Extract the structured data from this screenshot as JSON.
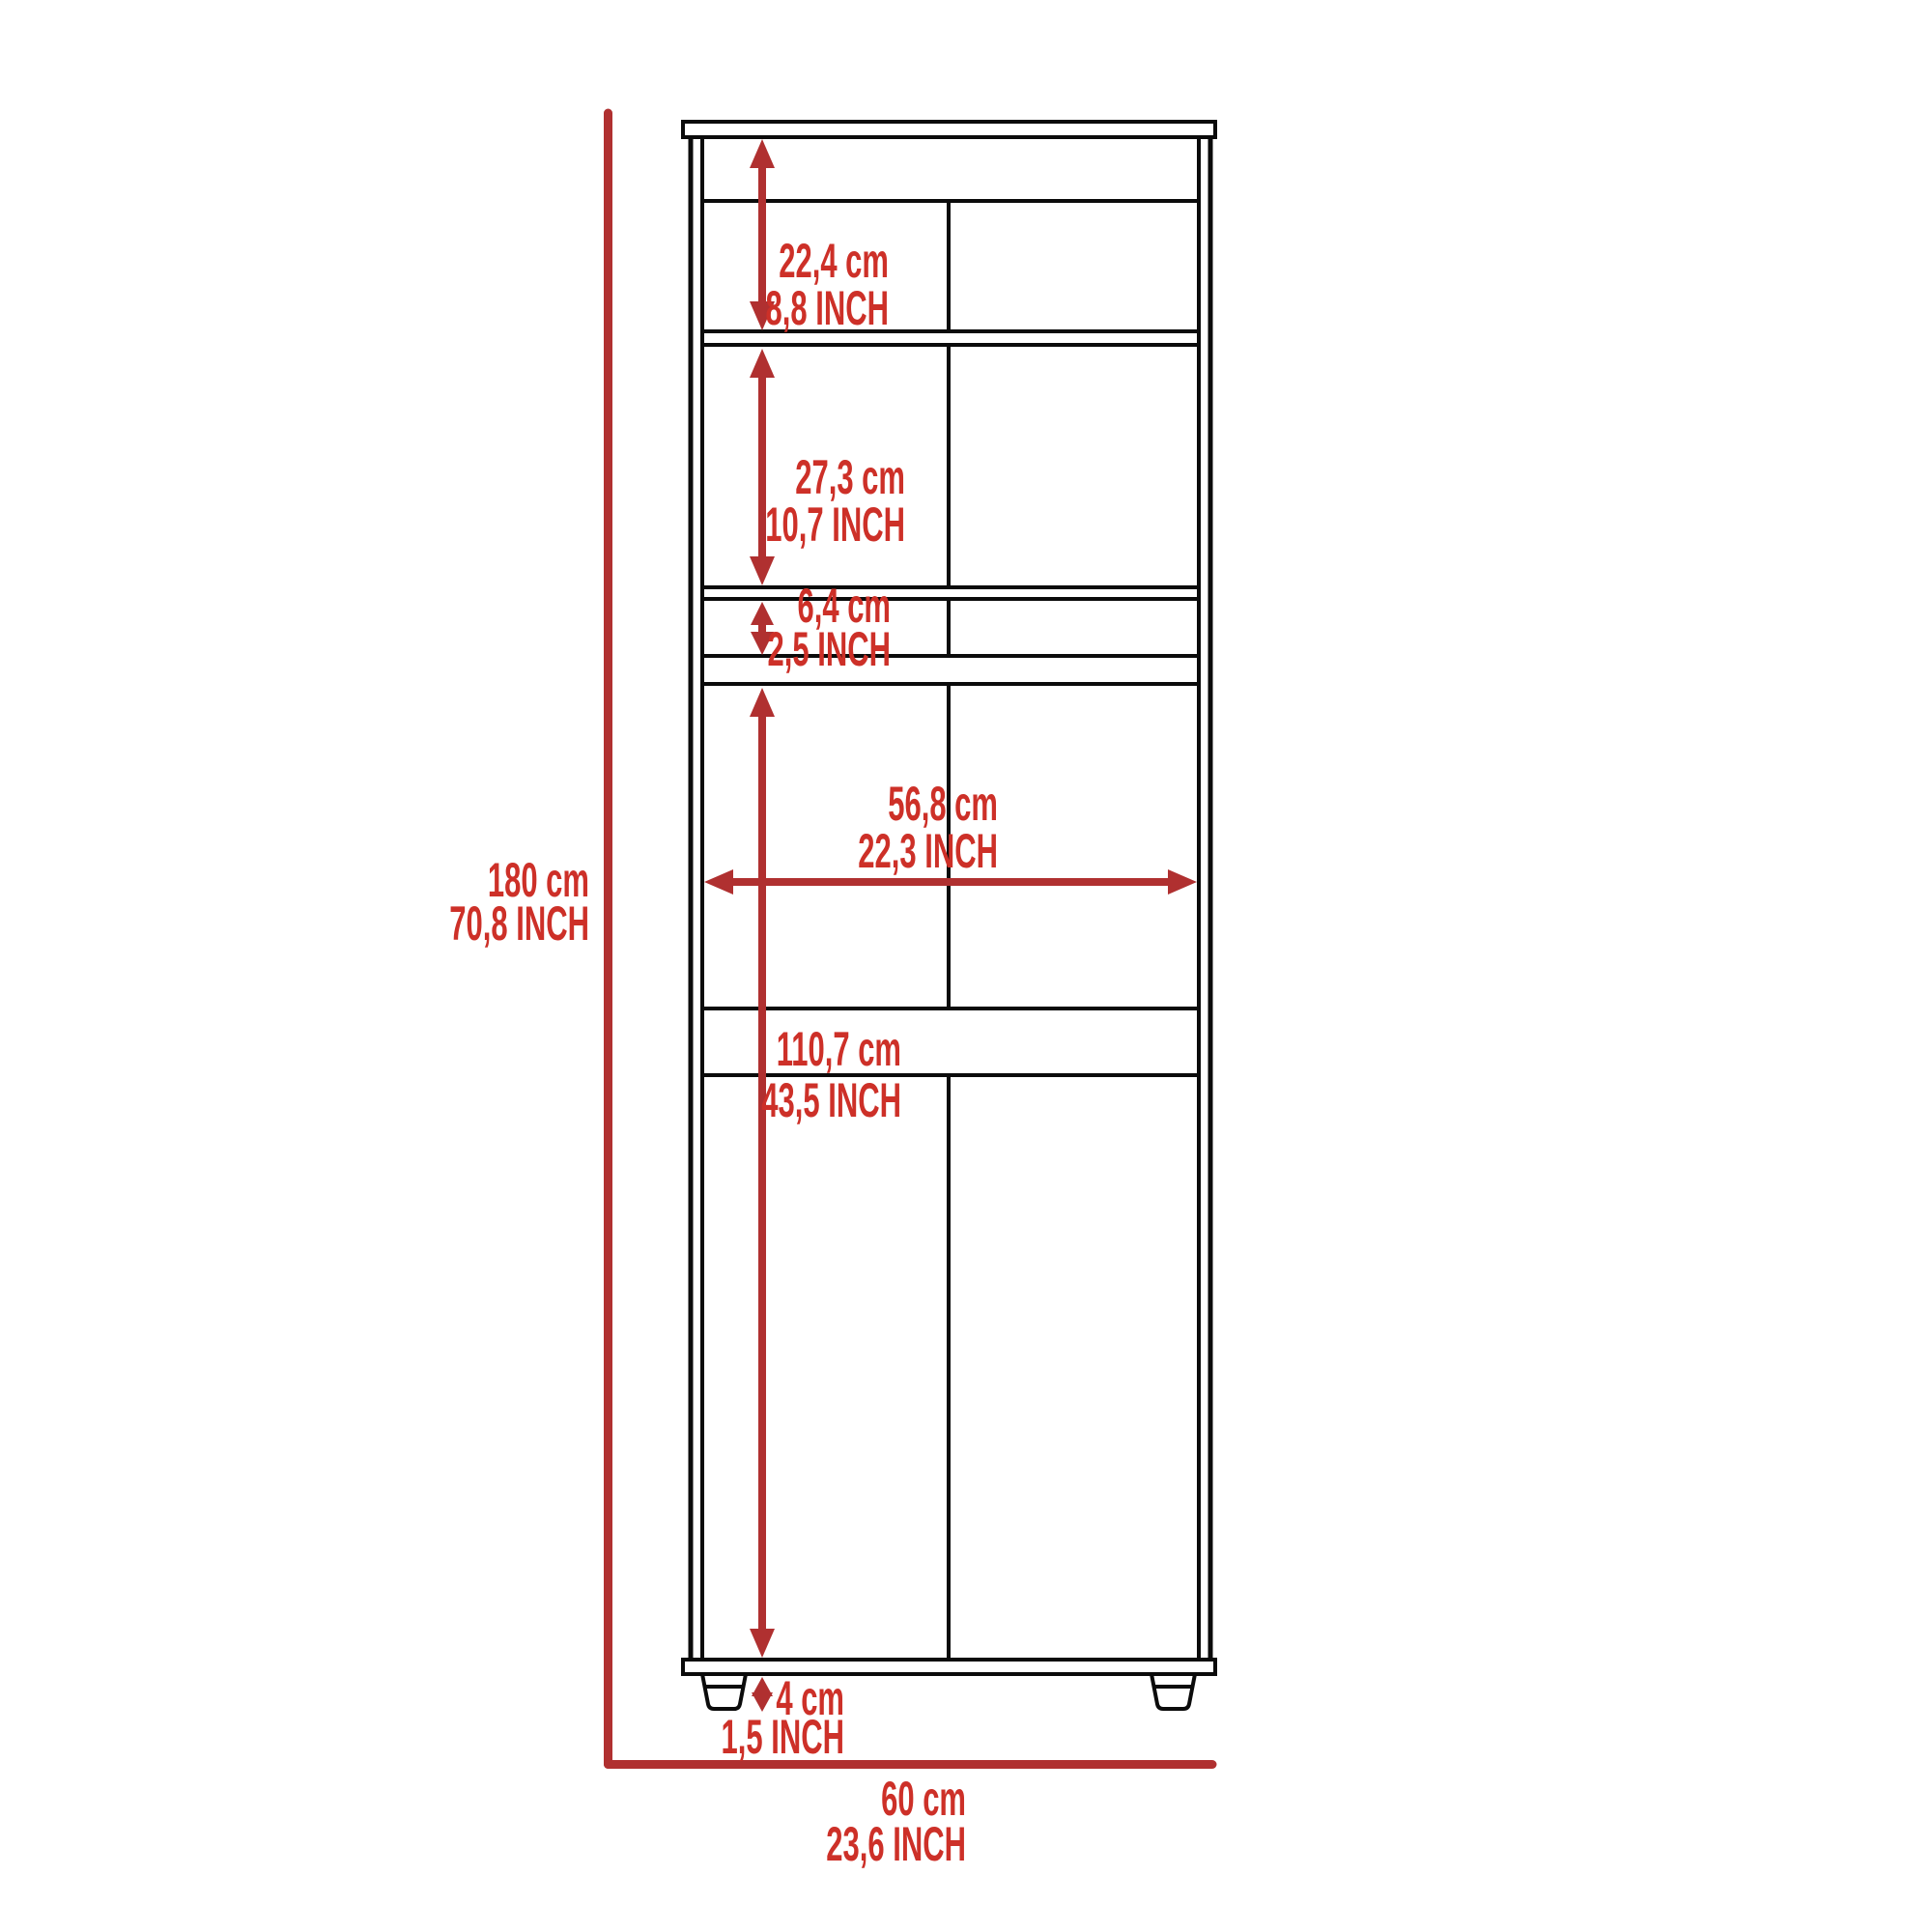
{
  "diagram": {
    "type": "furniture-dimension-drawing",
    "subject": "tall two-door pantry cabinet, front elevation",
    "colors": {
      "background": "#ffffff",
      "outline": "#0b0b0b",
      "dimension_lines": "#b03030",
      "dimension_text": "#cd3028"
    },
    "dimensions": {
      "top_shelf_section": {
        "cm": "22,4 cm",
        "inch": "8,8 INCH"
      },
      "upper_cabinet_section": {
        "cm": "27,3 cm",
        "inch": "10,7 INCH"
      },
      "drawer_section": {
        "cm": "6,4 cm",
        "inch": "2,5 INCH"
      },
      "interior_width": {
        "cm": "56,8 cm",
        "inch": "22,3 INCH"
      },
      "lower_cabinet_section": {
        "cm": "110,7 cm",
        "inch": "43,5 INCH"
      },
      "overall_height": {
        "cm": "180 cm",
        "inch": "70,8 INCH"
      },
      "feet_height": {
        "cm": "4 cm",
        "inch": "1,5 INCH"
      },
      "overall_width": {
        "cm": "60 cm",
        "inch": "23,6 INCH"
      }
    }
  }
}
